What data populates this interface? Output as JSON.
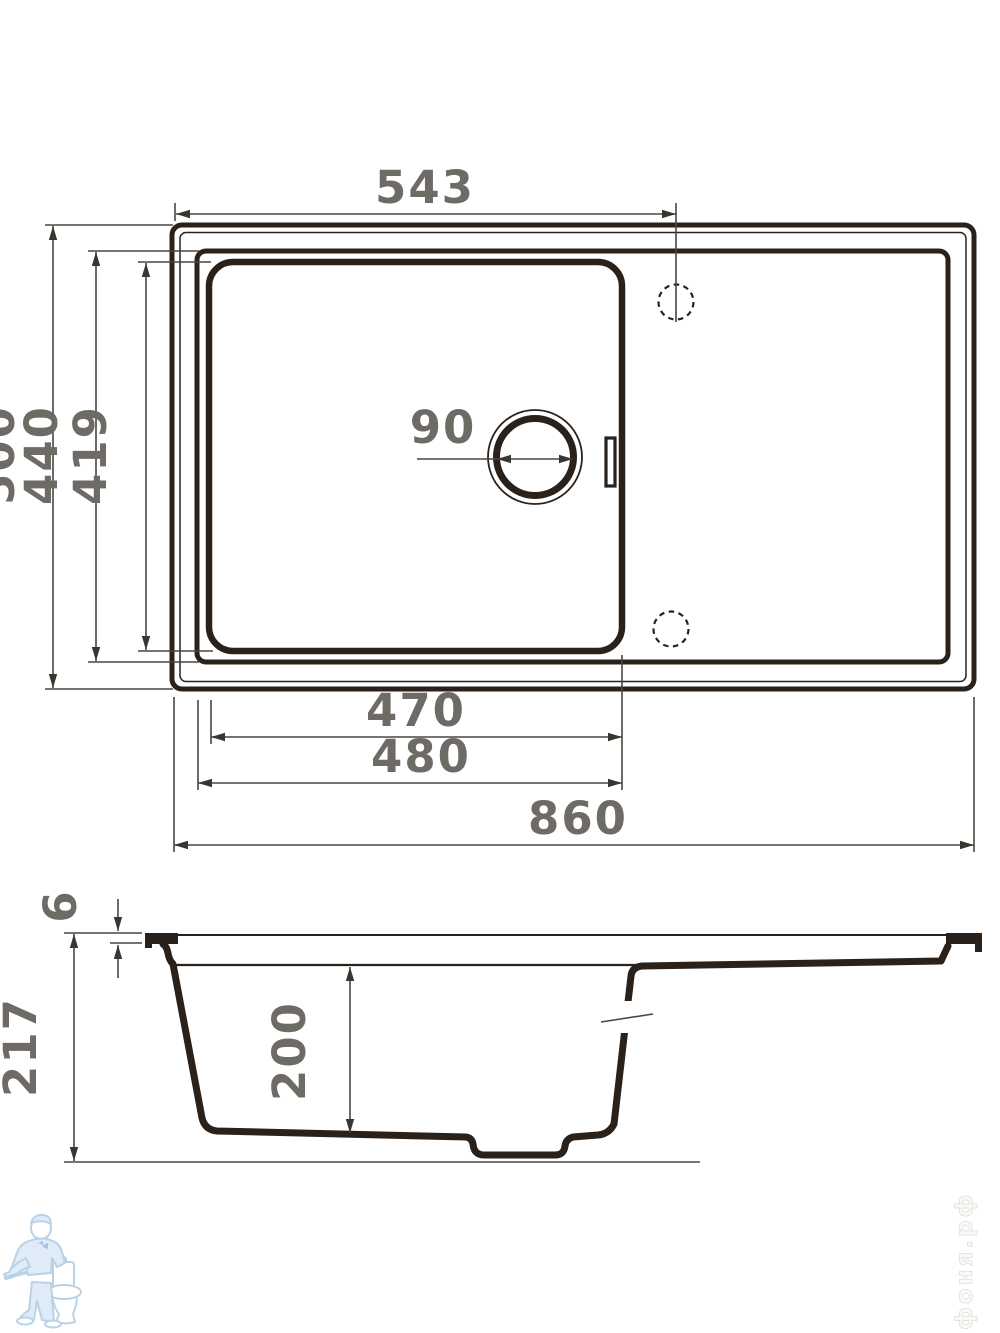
{
  "drawing": {
    "plan": {
      "tap_hole_offset": "543",
      "overall_depth": "500",
      "inner_depth": "440",
      "bowl_depth_plan": "419",
      "drain_diameter": "90",
      "bowl_width": "470",
      "inner_width": "480",
      "overall_width": "860"
    },
    "section": {
      "rim_height": "6",
      "overall_height": "217",
      "bowl_depth": "200"
    }
  },
  "watermark": {
    "site": "афоня.рф"
  },
  "colors": {
    "line": "#2a211a",
    "dimension_line": "#4a4540",
    "dimension_text": "#6e6a66",
    "watermark_blue": "#a9c7e3"
  }
}
